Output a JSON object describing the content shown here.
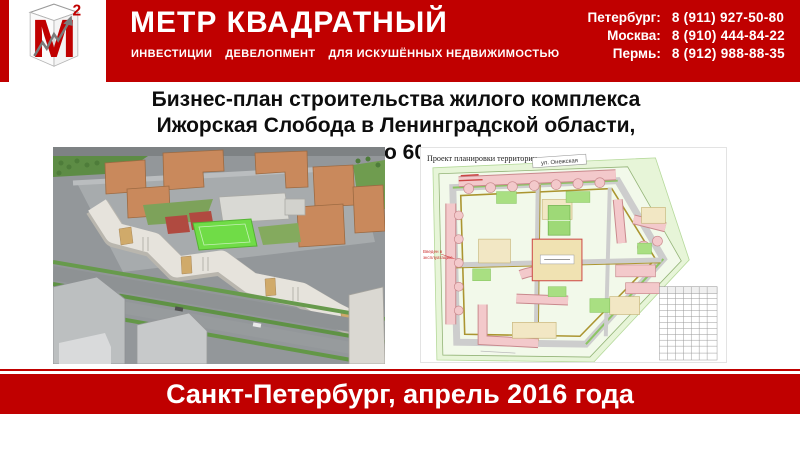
{
  "colors": {
    "accent_red": "#c00000",
    "title_text": "#0d0d0d",
    "header_text": "#ffffff"
  },
  "header": {
    "logo": {
      "letter": "М",
      "superscript": "2"
    },
    "company_name": "МЕТР КВАДРАТНЫЙ",
    "tagline_parts": [
      "ИНВЕСТИЦИИ",
      "ДЕВЕЛОПМЕНТ",
      "ДЛЯ ИСКУШЁННЫХ НЕДВИЖИМОСТЬЮ"
    ],
    "contacts": [
      {
        "city": "Петербург:",
        "phone": "8 (911) 927-50-80"
      },
      {
        "city": "Москва:",
        "phone": "8 (910) 444-84-22"
      },
      {
        "city": "Пермь:",
        "phone": "8 (912) 988-88-35"
      }
    ]
  },
  "title": {
    "line1": "Бизнес-план строительства жилого комплекса",
    "line2": "Ижорская Слобода в Ленинградской области,",
    "line3_visible_fragment": "о 60"
  },
  "images": {
    "render3d": {
      "description": "3D визуализация жилого комплекса"
    },
    "site_plan": {
      "caption": "Проект планировки территории",
      "street_label": "ул. Онежская",
      "red_note_lines": [
        "Введен в",
        "эксплуатацию"
      ]
    }
  },
  "footer": {
    "text": "Санкт-Петербург, апрель 2016 года"
  }
}
